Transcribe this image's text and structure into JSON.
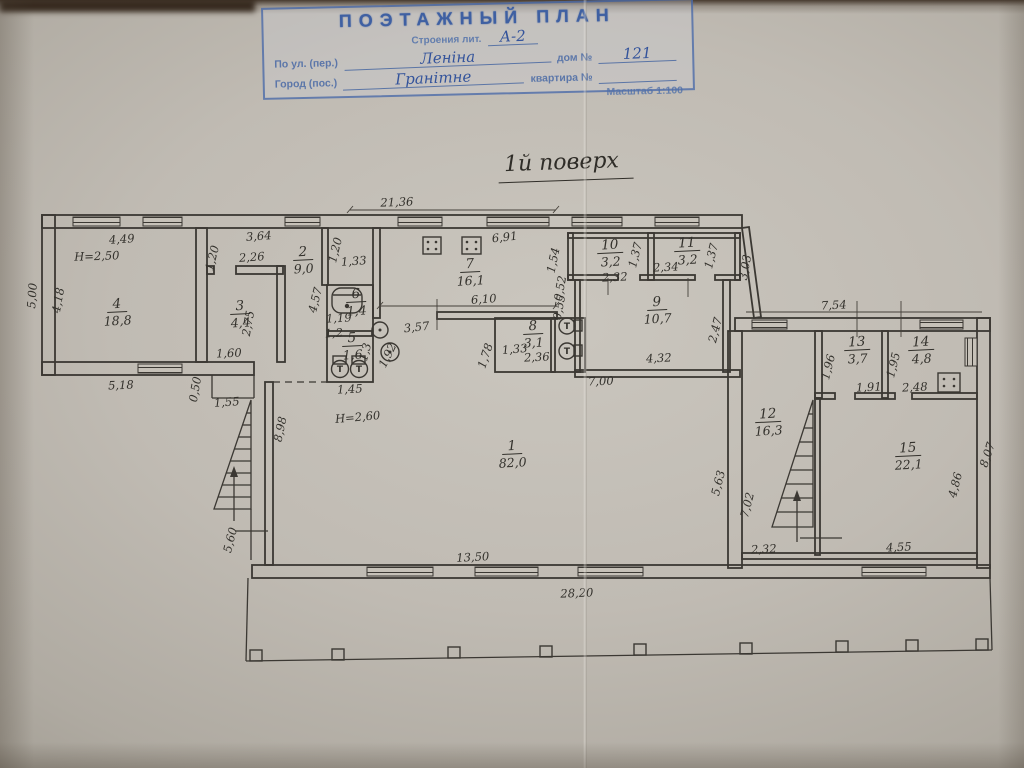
{
  "stamp": {
    "title": "ПОЭТАЖНЫЙ ПЛАН",
    "building_label": "Строения лит.",
    "building_value": "А-2",
    "street_label": "По ул. (пер.)",
    "street_value": "Леніна",
    "house_label": "дом №",
    "house_value": "121",
    "city_label": "Город (пос.)",
    "city_value": "Гранітне",
    "apartment_label": "квартира №",
    "apartment_value": "",
    "scale_label": "Масштаб 1:100",
    "ink_color": "#3f60a2"
  },
  "plan": {
    "floor_title": "1й поверх",
    "toilet_mark": "Т",
    "ink_color": "#33312c",
    "rooms": [
      {
        "number": "1",
        "area": "82,0",
        "x": 512,
        "y": 450
      },
      {
        "number": "2",
        "area": "9,0",
        "x": 303,
        "y": 256
      },
      {
        "number": "3",
        "area": "4,4",
        "x": 240,
        "y": 310
      },
      {
        "number": "4",
        "area": "18,8",
        "x": 117,
        "y": 308
      },
      {
        "number": "5",
        "area": "1,6",
        "x": 352,
        "y": 342
      },
      {
        "number": "6",
        "area": "1,4",
        "x": 356,
        "y": 298
      },
      {
        "number": "7",
        "area": "16,1",
        "x": 470,
        "y": 268
      },
      {
        "number": "8",
        "area": "3,1",
        "x": 533,
        "y": 330
      },
      {
        "number": "9",
        "area": "10,7",
        "x": 657,
        "y": 306
      },
      {
        "number": "10",
        "area": "3,2",
        "x": 610,
        "y": 249
      },
      {
        "number": "11",
        "area": "3,2",
        "x": 687,
        "y": 247
      },
      {
        "number": "12",
        "area": "16,3",
        "x": 768,
        "y": 418
      },
      {
        "number": "13",
        "area": "3,7",
        "x": 857,
        "y": 346
      },
      {
        "number": "14",
        "area": "4,8",
        "x": 921,
        "y": 346
      },
      {
        "number": "15",
        "area": "22,1",
        "x": 908,
        "y": 452
      }
    ],
    "dimensions": [
      {
        "text": "21,36",
        "x": 397,
        "y": 206,
        "rot": -2
      },
      {
        "text": "4,49",
        "x": 122,
        "y": 243,
        "rot": -4
      },
      {
        "text": "3,64",
        "x": 259,
        "y": 240,
        "rot": -4
      },
      {
        "text": "2,26",
        "x": 252,
        "y": 261,
        "rot": -4
      },
      {
        "text": "1,20",
        "x": 216,
        "y": 259,
        "rot": -76
      },
      {
        "text": "H=2,50",
        "x": 97,
        "y": 260,
        "rot": -2
      },
      {
        "text": "5,00",
        "x": 36,
        "y": 296,
        "rot": -86
      },
      {
        "text": "4,18",
        "x": 62,
        "y": 301,
        "rot": -80
      },
      {
        "text": "2,75",
        "x": 252,
        "y": 324,
        "rot": -80
      },
      {
        "text": "1,60",
        "x": 229,
        "y": 357,
        "rot": -2
      },
      {
        "text": "5,18",
        "x": 121,
        "y": 389,
        "rot": -2
      },
      {
        "text": "0,50",
        "x": 199,
        "y": 390,
        "rot": -80
      },
      {
        "text": "1,55",
        "x": 227,
        "y": 406,
        "rot": -4
      },
      {
        "text": "5,60",
        "x": 234,
        "y": 541,
        "rot": -76
      },
      {
        "text": "8,98",
        "x": 284,
        "y": 430,
        "rot": -78
      },
      {
        "text": "H=2,60",
        "x": 358,
        "y": 421,
        "rot": -5
      },
      {
        "text": "1,45",
        "x": 350,
        "y": 393,
        "rot": -3
      },
      {
        "text": "1,20",
        "x": 339,
        "y": 251,
        "rot": -76
      },
      {
        "text": "1,33",
        "x": 354,
        "y": 265,
        "rot": -4
      },
      {
        "text": "4,57",
        "x": 319,
        "y": 301,
        "rot": -76
      },
      {
        "text": "1,19",
        "x": 339,
        "y": 322,
        "rot": -3
      },
      {
        "text": "1,2",
        "x": 334,
        "y": 337,
        "rot": -3
      },
      {
        "text": "1,3",
        "x": 369,
        "y": 353,
        "rot": -76
      },
      {
        "text": "1,92",
        "x": 391,
        "y": 357,
        "rot": -64
      },
      {
        "text": "3,57",
        "x": 417,
        "y": 331,
        "rot": -6
      },
      {
        "text": "6,10",
        "x": 484,
        "y": 303,
        "rot": -4
      },
      {
        "text": "6,91",
        "x": 505,
        "y": 241,
        "rot": -6
      },
      {
        "text": "1,33",
        "x": 515,
        "y": 353,
        "rot": -5
      },
      {
        "text": "2,36",
        "x": 537,
        "y": 361,
        "rot": -3
      },
      {
        "text": "1,78",
        "x": 489,
        "y": 357,
        "rot": -72
      },
      {
        "text": "0,52",
        "x": 564,
        "y": 289,
        "rot": -80
      },
      {
        "text": "0,55",
        "x": 563,
        "y": 308,
        "rot": -80
      },
      {
        "text": "1,54",
        "x": 557,
        "y": 261,
        "rot": -78
      },
      {
        "text": "2,32",
        "x": 615,
        "y": 281,
        "rot": -3
      },
      {
        "text": "1,37",
        "x": 639,
        "y": 256,
        "rot": -76
      },
      {
        "text": "2,34",
        "x": 666,
        "y": 271,
        "rot": -3
      },
      {
        "text": "1,37",
        "x": 715,
        "y": 257,
        "rot": -76
      },
      {
        "text": "3,03",
        "x": 749,
        "y": 268,
        "rot": -80
      },
      {
        "text": "4,32",
        "x": 659,
        "y": 362,
        "rot": -3
      },
      {
        "text": "2,47",
        "x": 719,
        "y": 331,
        "rot": -76
      },
      {
        "text": "7,00",
        "x": 601,
        "y": 385,
        "rot": -2
      },
      {
        "text": "7,54",
        "x": 834,
        "y": 309,
        "rot": -3
      },
      {
        "text": "1,96",
        "x": 832,
        "y": 368,
        "rot": -76
      },
      {
        "text": "1,91",
        "x": 869,
        "y": 391,
        "rot": -3
      },
      {
        "text": "1,95",
        "x": 897,
        "y": 366,
        "rot": -76
      },
      {
        "text": "2,48",
        "x": 915,
        "y": 391,
        "rot": -3
      },
      {
        "text": "8,07",
        "x": 991,
        "y": 456,
        "rot": -72
      },
      {
        "text": "4,86",
        "x": 959,
        "y": 486,
        "rot": -76
      },
      {
        "text": "4,55",
        "x": 899,
        "y": 551,
        "rot": -3
      },
      {
        "text": "2,32",
        "x": 764,
        "y": 553,
        "rot": -3
      },
      {
        "text": "7,02",
        "x": 751,
        "y": 506,
        "rot": -76
      },
      {
        "text": "5,63",
        "x": 722,
        "y": 484,
        "rot": -76
      },
      {
        "text": "13,50",
        "x": 473,
        "y": 561,
        "rot": -3
      },
      {
        "text": "28,20",
        "x": 577,
        "y": 597,
        "rot": -2
      }
    ]
  }
}
